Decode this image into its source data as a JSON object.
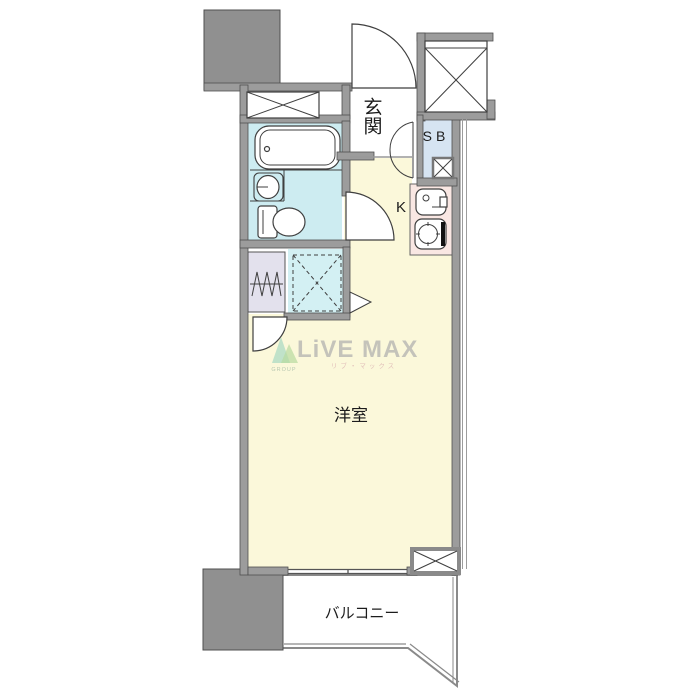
{
  "plan": {
    "labels": {
      "entrance": "玄関",
      "shoe_box": "SB",
      "kitchen": "K",
      "western_room": "洋室",
      "balcony": "バルコニー"
    },
    "watermark": {
      "brand": "LiVE MAX",
      "group": "GROUP",
      "brand_kana": "リブ・マックス"
    },
    "colors": {
      "wall": "#9c9c9c",
      "wall_edge": "#4f4f4f",
      "floor_room": "#fbf8da",
      "floor_entrance": "#ffffff",
      "bath": "#cdecf1",
      "bathtub": "#dcf4f8",
      "shoe_box": "#d6e4f2",
      "kitchen_counter": "#f9e7e3",
      "washer_pan": "#e3e1ed",
      "fridge_space": "#d3f0f3",
      "balcony_line": "#8a8a8a",
      "watermark_text": "#a0a0a6",
      "watermark_kana": "#d09aa4",
      "watermark_icon_teal": "#6fc4b4",
      "watermark_icon_green": "#8cc87a"
    }
  }
}
